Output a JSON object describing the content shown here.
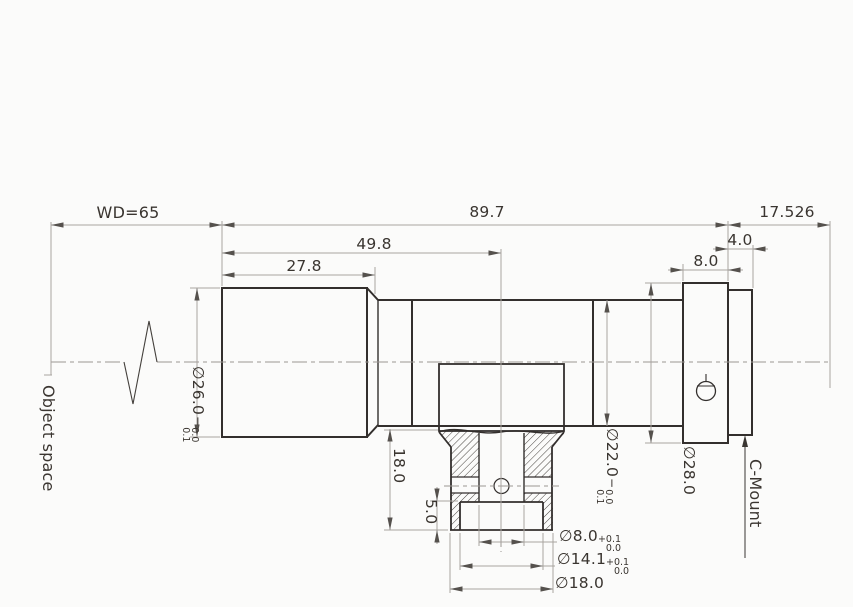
{
  "drawing": {
    "type": "mechanical-dimension-drawing",
    "subject": "lens with C-Mount interface, mounting clamp cross-section",
    "dims": {
      "working_distance": "WD=65",
      "body_length": "89.7",
      "flange_distance": "17.526",
      "front_to_clamp_center": "49.8",
      "front_barrel_length": "27.8",
      "ring_width": "8.0",
      "mount_flange_width": "4.0",
      "clamp_height": "18.0",
      "counterbore_depth": "5.0",
      "dia26": {
        "base": "∅26.0",
        "sign": "−",
        "upper": "0.0",
        "lower": "0.1"
      },
      "dia22": {
        "base": "∅22.0",
        "sign": "−",
        "upper": "0.0",
        "lower": "0.1"
      },
      "dia28": {
        "base": "∅28.0"
      },
      "dia8": {
        "base": "∅8.0",
        "upper": "+0.1",
        "lower": "0.0"
      },
      "dia141": {
        "base": "∅14.1",
        "upper": "+0.1",
        "lower": "0.0"
      },
      "dia18": {
        "base": "∅18.0"
      }
    },
    "labels": {
      "object_space": "Object space",
      "c_mount": "C-Mount"
    },
    "colors": {
      "part_line": "#332f2d",
      "dim_line": "#a8a4a0",
      "arrow": "#55514d",
      "text": "#3a3530",
      "background": "#fbfbfa"
    }
  }
}
